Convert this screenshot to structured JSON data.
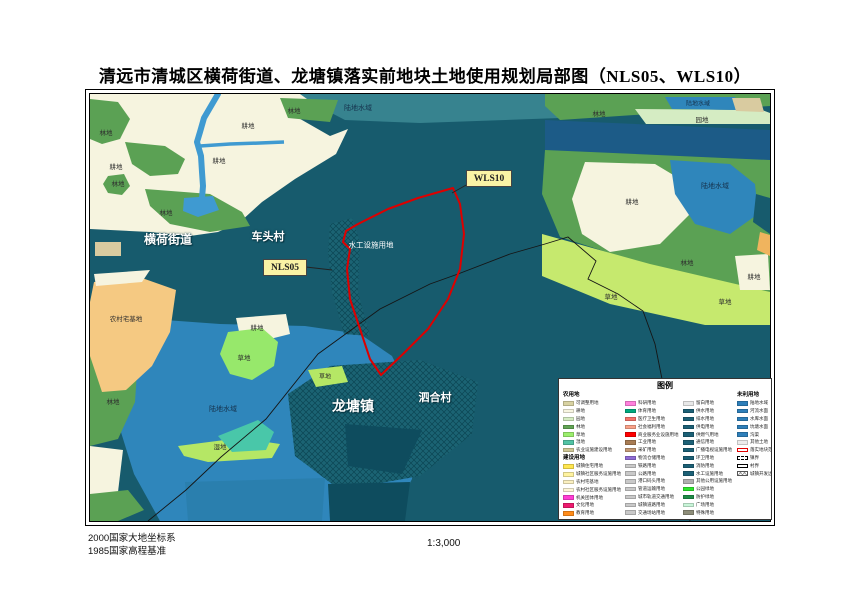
{
  "page": {
    "title": "清远市清城区横荷街道、龙塘镇落实前地块土地使用规划局部图（NLS05、WLS10）"
  },
  "footer": {
    "datum1": "2000国家大地坐标系",
    "datum2": "1985国家高程基准",
    "scale": "1:3,000"
  },
  "palette": {
    "deep_teal_base": "#175b6d",
    "teal_band": "#37838f",
    "cultivated_cream": "#f6f4df",
    "forest_green": "#5ba154",
    "orchard_mint": "#d5ecc3",
    "water_blue": "#2f86bb",
    "river_dark_blue": "#1c5b87",
    "stream_blue": "#3f9ad1",
    "grass_green": "#c6e96e",
    "homestead_orange": "#f5c982",
    "wetland_turquoise": "#49c7a9",
    "plot_boundary_red": "#dd0000",
    "callout_yellow": "#faf3a5"
  },
  "map": {
    "labels": [
      {
        "t": "横荷街道",
        "x": 78,
        "y": 145,
        "cls": "w",
        "fs": 12
      },
      {
        "t": "车头村",
        "x": 178,
        "y": 142,
        "cls": "w",
        "fs": 11
      },
      {
        "t": "龙塘镇",
        "x": 263,
        "y": 312,
        "cls": "w",
        "fs": 14
      },
      {
        "t": "泗合村",
        "x": 345,
        "y": 303,
        "cls": "w",
        "fs": 11
      },
      {
        "t": "水工设施用地",
        "x": 281,
        "y": 151,
        "cls": "ws",
        "fs": 7.5
      },
      {
        "t": "陆地水域",
        "x": 268,
        "y": 14,
        "cls": "n",
        "fs": 7
      },
      {
        "t": "陆地水域",
        "x": 608,
        "y": 9,
        "cls": "n",
        "fs": 6
      },
      {
        "t": "陆地水域",
        "x": 625,
        "y": 92,
        "cls": "n",
        "fs": 7
      },
      {
        "t": "陆地水域",
        "x": 133,
        "y": 315,
        "cls": "n",
        "fs": 7
      },
      {
        "t": "林地",
        "x": 16,
        "y": 38,
        "cls": "d",
        "fs": 6.5
      },
      {
        "t": "林地",
        "x": 204,
        "y": 16,
        "cls": "d",
        "fs": 6.5
      },
      {
        "t": "林地",
        "x": 28,
        "y": 89,
        "cls": "d",
        "fs": 6.5
      },
      {
        "t": "林地",
        "x": 76,
        "y": 118,
        "cls": "d",
        "fs": 6.5
      },
      {
        "t": "林地",
        "x": 509,
        "y": 19,
        "cls": "d",
        "fs": 6.5
      },
      {
        "t": "林地",
        "x": 597,
        "y": 168,
        "cls": "d",
        "fs": 6.5
      },
      {
        "t": "林地",
        "x": 23,
        "y": 307,
        "cls": "d",
        "fs": 6.5
      },
      {
        "t": "耕地",
        "x": 158,
        "y": 31,
        "cls": "d",
        "fs": 6.5
      },
      {
        "t": "耕地",
        "x": 129,
        "y": 66,
        "cls": "d",
        "fs": 6.5
      },
      {
        "t": "耕地",
        "x": 26,
        "y": 72,
        "cls": "d",
        "fs": 6.5
      },
      {
        "t": "耕地",
        "x": 542,
        "y": 107,
        "cls": "d",
        "fs": 6.5
      },
      {
        "t": "耕地",
        "x": 664,
        "y": 182,
        "cls": "d",
        "fs": 6.5
      },
      {
        "t": "耕地",
        "x": 167,
        "y": 233,
        "cls": "d",
        "fs": 6.5
      },
      {
        "t": "园地",
        "x": 612,
        "y": 25,
        "cls": "d",
        "fs": 6.5
      },
      {
        "t": "草地",
        "x": 521,
        "y": 202,
        "cls": "d",
        "fs": 6.5
      },
      {
        "t": "草地",
        "x": 635,
        "y": 207,
        "cls": "d",
        "fs": 6.5
      },
      {
        "t": "草地",
        "x": 154,
        "y": 263,
        "cls": "d",
        "fs": 6.5
      },
      {
        "t": "草地",
        "x": 235,
        "y": 282,
        "cls": "d",
        "fs": 6
      },
      {
        "t": "湿地",
        "x": 130,
        "y": 352,
        "cls": "d",
        "fs": 6.5
      },
      {
        "t": "农村宅基地",
        "x": 36,
        "y": 224,
        "cls": "d",
        "fs": 6.5
      }
    ],
    "callouts": [
      {
        "t": "WLS10",
        "x": 376,
        "y": 76,
        "w": 46,
        "h": 17
      },
      {
        "t": "NLS05",
        "x": 173,
        "y": 165,
        "w": 44,
        "h": 17
      }
    ]
  },
  "legend": {
    "title": "图例",
    "columns": [
      {
        "entries": [
          {
            "h": "农用地"
          },
          {
            "c": "#d8d2a2",
            "t": "可调整用地"
          },
          {
            "c": "#f7f5e1",
            "t": "耕地"
          },
          {
            "c": "#d5ecc3",
            "t": "园地"
          },
          {
            "c": "#62a555",
            "t": "林地"
          },
          {
            "c": "#9bee6d",
            "t": "草地"
          },
          {
            "c": "#52c3a4",
            "t": "湿地"
          },
          {
            "c": "#cfc795",
            "t": "农业设施建设用地"
          },
          {
            "h": "建设用地"
          },
          {
            "c": "#ffe64f",
            "t": "城镇住宅用地"
          },
          {
            "c": "#fff3a0",
            "t": "城镇社区服务设施用地"
          },
          {
            "c": "#fbf0c0",
            "t": "农村宅基地"
          },
          {
            "c": "#fdf6d8",
            "t": "农村社区服务设施用地"
          },
          {
            "c": "#ff3dd4",
            "t": "机关团体用地"
          },
          {
            "c": "#ed1a6e",
            "t": "文化用地"
          },
          {
            "c": "#ff8c1a",
            "t": "教育用地"
          }
        ]
      },
      {
        "entries": [
          {
            "c": "#ff80dd",
            "t": "科研用地"
          },
          {
            "c": "#00a87e",
            "t": "体育用地"
          },
          {
            "c": "#f4726a",
            "t": "医疗卫生用地"
          },
          {
            "c": "#f9a188",
            "t": "社会福利用地"
          },
          {
            "c": "#ff0000",
            "t": "商业服务业设施用地"
          },
          {
            "c": "#a87c54",
            "t": "工业用地"
          },
          {
            "c": "#c49a76",
            "t": "采矿用地"
          },
          {
            "c": "#8f6bd4",
            "t": "物流仓储用地"
          },
          {
            "c": "#c9c9c9",
            "t": "铁路用地"
          },
          {
            "c": "#c9c9c9",
            "t": "公路用地"
          },
          {
            "c": "#c9c9c9",
            "t": "港口码头用地"
          },
          {
            "c": "#c9c9c9",
            "t": "管道运输用地"
          },
          {
            "c": "#c9c9c9",
            "t": "城市轨道交通用地"
          },
          {
            "c": "#c9c9c9",
            "t": "城镇道路用地"
          },
          {
            "c": "#c9c9c9",
            "t": "交通场站用地"
          }
        ]
      },
      {
        "entries": [
          {
            "c": "#e8e8e8",
            "t": "留白用地"
          },
          {
            "c": "#1c6076",
            "t": "供水用地"
          },
          {
            "c": "#1c6076",
            "t": "排水用地"
          },
          {
            "c": "#1c6076",
            "t": "供电用地"
          },
          {
            "c": "#1c6076",
            "t": "供燃气用地"
          },
          {
            "c": "#1c6076",
            "t": "通信用地"
          },
          {
            "c": "#1c6076",
            "t": "广播电视设施用地"
          },
          {
            "c": "#1c6076",
            "t": "环卫用地"
          },
          {
            "c": "#1c6076",
            "t": "消防用地"
          },
          {
            "c": "#1c6076",
            "t": "水工设施用地"
          },
          {
            "c": "#b0b0b0",
            "t": "其他公用设施用地"
          },
          {
            "c": "#2ee52e",
            "t": "公园绿地"
          },
          {
            "c": "#1e8c46",
            "t": "防护绿地"
          },
          {
            "c": "#c8f5d8",
            "t": "广场用地"
          },
          {
            "c": "#8d8d79",
            "t": "特殊用地"
          }
        ]
      },
      {
        "entries": [
          {
            "h": "未利用地"
          },
          {
            "c": "#2e7fba",
            "t": "陆地水域"
          },
          {
            "c": "#2e7fba",
            "t": "河流水面"
          },
          {
            "c": "#2e7fba",
            "t": "水库水面"
          },
          {
            "c": "#2e7fba",
            "t": "坑塘水面"
          },
          {
            "c": "#2e7fba",
            "t": "沟渠"
          },
          {
            "c": "#ececec",
            "t": "其他土地"
          },
          {
            "s": "sw-red",
            "t": "落实地块范围"
          },
          {
            "s": "sw-dash",
            "t": "镇界"
          },
          {
            "s": "sw-out",
            "t": "村界"
          },
          {
            "s": "sw-x",
            "t": "城镇开发边界"
          }
        ]
      }
    ]
  }
}
